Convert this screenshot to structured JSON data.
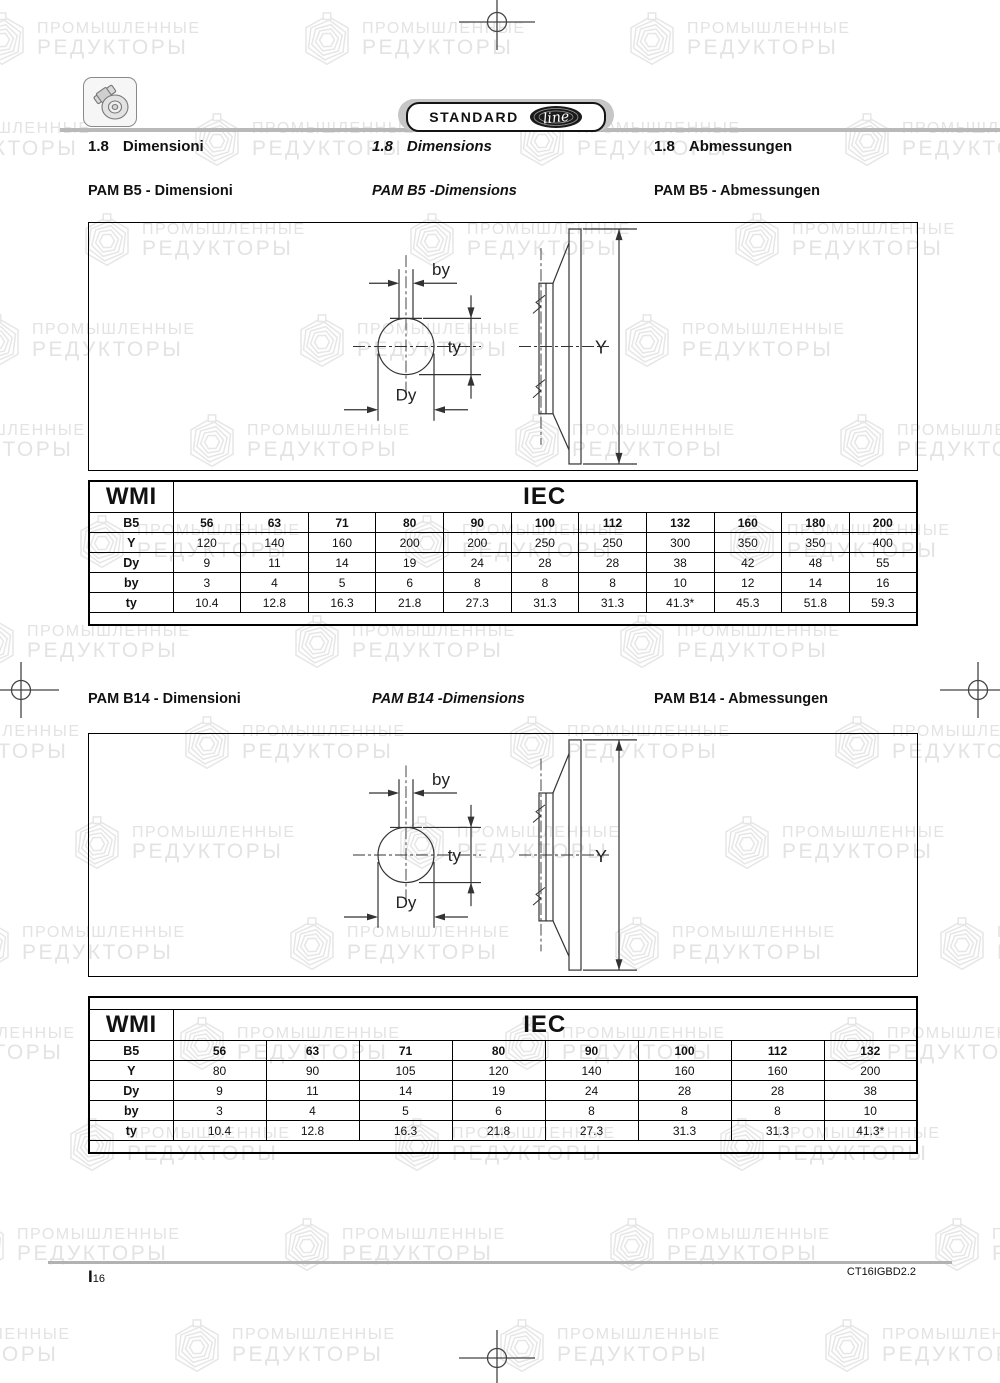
{
  "badge": {
    "standard": "STANDARD",
    "line": "line"
  },
  "watermark": {
    "line1": "ПРОМЫШЛЕННЫЕ",
    "line2": "РЕДУКТОРЫ"
  },
  "heading": {
    "no": "1.8",
    "it": "Dimensioni",
    "en": "Dimensions",
    "de": "Abmessungen"
  },
  "pam_b5": {
    "caption_it": "PAM B5  - Dimensioni",
    "caption_en": "PAM B5  -Dimensions",
    "caption_de": "PAM B5  - Abmessungen"
  },
  "pam_b14": {
    "caption_it": "PAM B14  - Dimensioni",
    "caption_en": "PAM B14  -Dimensions",
    "caption_de": "PAM B14  - Abmessungen"
  },
  "figure_labels": {
    "by": "by",
    "ty": "ty",
    "dy": "Dy",
    "y": "Y"
  },
  "tables": [
    {
      "name": "pam-b5-table",
      "brand": "WMI",
      "std": "IEC",
      "size_row_label": "B5",
      "sizes": [
        "56",
        "63",
        "71",
        "80",
        "90",
        "100",
        "112",
        "132",
        "160",
        "180",
        "200"
      ],
      "rows": [
        {
          "label": "Y",
          "values": [
            "120",
            "140",
            "160",
            "200",
            "200",
            "250",
            "250",
            "300",
            "350",
            "350",
            "400"
          ]
        },
        {
          "label": "Dy",
          "values": [
            "9",
            "11",
            "14",
            "19",
            "24",
            "28",
            "28",
            "38",
            "42",
            "48",
            "55"
          ]
        },
        {
          "label": "by",
          "values": [
            "3",
            "4",
            "5",
            "6",
            "8",
            "8",
            "8",
            "10",
            "12",
            "14",
            "16"
          ]
        },
        {
          "label": "ty",
          "values": [
            "10.4",
            "12.8",
            "16.3",
            "21.8",
            "27.3",
            "31.3",
            "31.3",
            "41.3*",
            "45.3",
            "51.8",
            "59.3"
          ]
        }
      ],
      "top_band": false
    },
    {
      "name": "pam-b14-table",
      "brand": "WMI",
      "std": "IEC",
      "size_row_label": "B5",
      "sizes": [
        "56",
        "63",
        "71",
        "80",
        "90",
        "100",
        "112",
        "132"
      ],
      "rows": [
        {
          "label": "Y",
          "values": [
            "80",
            "90",
            "105",
            "120",
            "140",
            "160",
            "160",
            "200"
          ]
        },
        {
          "label": "Dy",
          "values": [
            "9",
            "11",
            "14",
            "19",
            "24",
            "28",
            "28",
            "38"
          ]
        },
        {
          "label": "by",
          "values": [
            "3",
            "4",
            "5",
            "6",
            "8",
            "8",
            "8",
            "10"
          ]
        },
        {
          "label": "ty",
          "values": [
            "10.4",
            "12.8",
            "16.3",
            "21.8",
            "27.3",
            "31.3",
            "31.3",
            "41.3*"
          ]
        }
      ],
      "top_band": true
    }
  ],
  "footer": {
    "ref_prefix": "I",
    "ref_num": "16",
    "doc_code": "CT16IGBD2.2"
  },
  "colors": {
    "watermark": "#e3e3e3",
    "rule_gray": "#b9b9b9",
    "badge_gray": "#c6c6c6",
    "ink": "#111111"
  }
}
